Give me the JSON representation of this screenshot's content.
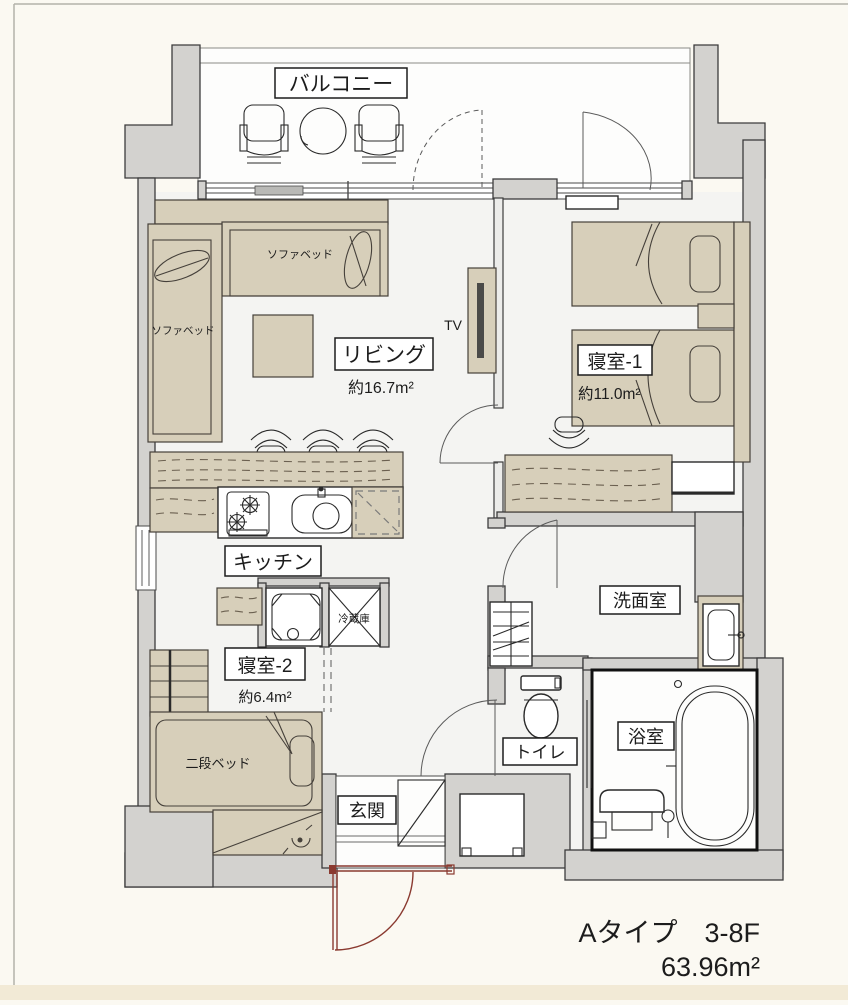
{
  "colors": {
    "wall_fill": "#d3d2cf",
    "wall_stroke": "#3c3c3c",
    "furniture_fill": "#d7cfba",
    "floor": "#f4f4f2",
    "balcony_floor": "#fdfdfc",
    "entry_door": "#8a3a30",
    "page_bg": "#fbf9f2",
    "footer_strip": "#f2ead6"
  },
  "rooms": {
    "balcony": {
      "label": "バルコニー"
    },
    "living": {
      "label": "リビング",
      "area": "約16.7m²"
    },
    "bedroom1": {
      "label": "寝室-1",
      "area": "約11.0m²"
    },
    "bedroom2": {
      "label": "寝室-2",
      "area": "約6.4m²"
    },
    "kitchen": {
      "label": "キッチン"
    },
    "washroom": {
      "label": "洗面室"
    },
    "toilet": {
      "label": "トイレ"
    },
    "bathroom": {
      "label": "浴室"
    },
    "entrance": {
      "label": "玄関"
    }
  },
  "furniture": {
    "sofa_bed_top": "ソファベッド",
    "sofa_bed_left": "ソファベッド",
    "bunk_bed": "二段ベッド",
    "tv": "TV",
    "fridge": "冷蔵庫"
  },
  "footer": {
    "type_floor": "Aタイプ　3-8F",
    "total_area": "63.96m²"
  }
}
